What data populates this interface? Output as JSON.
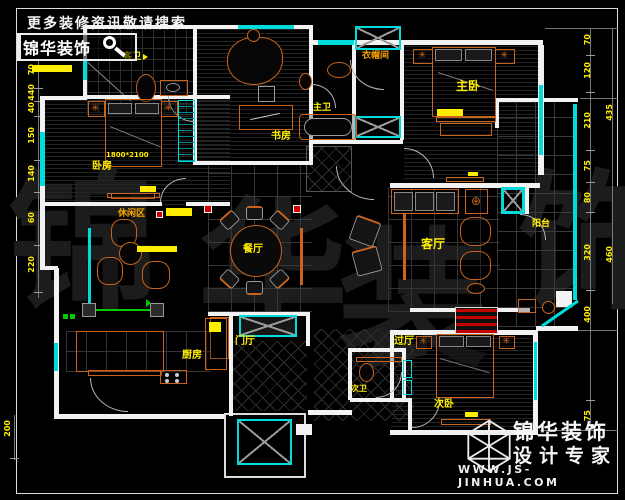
{
  "banner": {
    "slogan": "更多装修资讯敬请搜索",
    "search_text": "锦华装饰"
  },
  "branding": {
    "company": "锦华装饰",
    "tagline": "设计专家",
    "website": "WWW.JS-JINHUA.COM"
  },
  "watermark": {
    "char1": "锦",
    "char2": "华",
    "char3": "装",
    "char4": "饰"
  },
  "rooms": {
    "guest_bath": "客卫",
    "bedroom": "卧房",
    "study": "书房",
    "master_bath": "主卫",
    "cloakroom": "衣帽间",
    "master_bedroom": "主卧",
    "leisure": "休闲区",
    "dining": "餐厅",
    "living": "客厅",
    "balcony": "阳台",
    "foyer": "门厅",
    "hall": "过厅",
    "kitchen": "厨房",
    "second_bath": "次卫",
    "second_bedroom": "次卧"
  },
  "annotations": {
    "bed_size": "1800*2100"
  },
  "dims": {
    "left": [
      "70",
      "440",
      "40",
      "150",
      "140",
      "60",
      "220"
    ],
    "left_bottom": "200",
    "right": [
      "70",
      "120",
      "210",
      "75",
      "80",
      "320",
      "400",
      "75"
    ],
    "right_total": [
      "435",
      "460"
    ]
  },
  "colors": {
    "background": "#000000",
    "wall": "#f2f2f2",
    "window": "#00dcdc",
    "furniture": "#c8641e",
    "label": "#ffee00",
    "highlight_red": "#d40000",
    "wiring_green": "#00cc00",
    "watermark": "#1c1c1c"
  }
}
